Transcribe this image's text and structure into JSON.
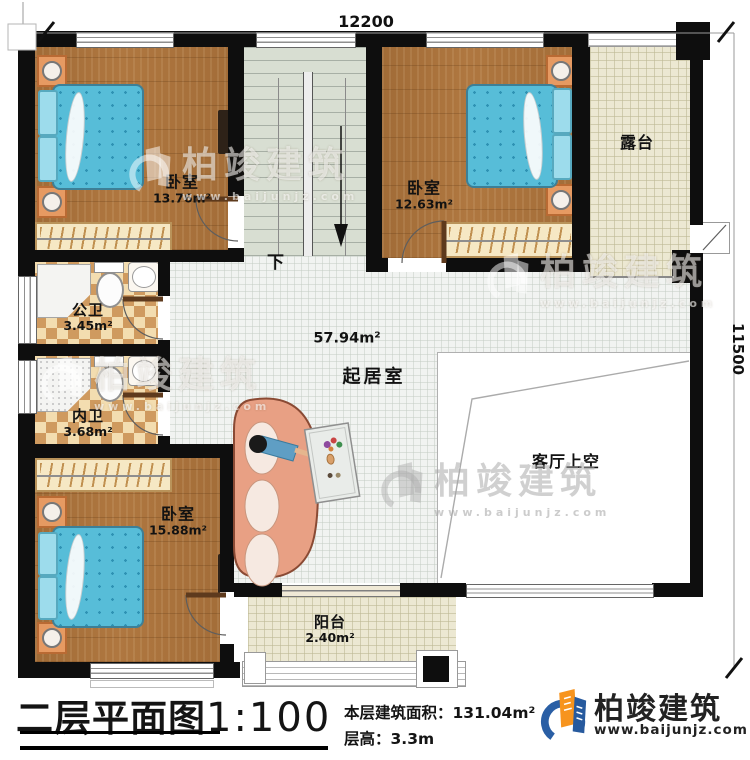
{
  "dims": {
    "width_label": "12200",
    "height_label": "11500"
  },
  "rooms": {
    "bedroom_tl": {
      "name": "卧室",
      "area": "13.76m²"
    },
    "bedroom_tr": {
      "name": "卧室",
      "area": "12.63m²"
    },
    "bedroom_bl": {
      "name": "卧室",
      "area": "15.88m²"
    },
    "terrace": {
      "name": "露台"
    },
    "public_bath": {
      "name": "公卫",
      "area": "3.45m²"
    },
    "inner_bath": {
      "name": "内卫",
      "area": "3.68m²"
    },
    "living": {
      "name": "起居室",
      "area": "57.94m²"
    },
    "living_void": {
      "name": "客厅上空"
    },
    "balcony": {
      "name": "阳台",
      "area": "2.40m²"
    },
    "stairs": {
      "down_label": "下"
    }
  },
  "title_block": {
    "title": "二层平面图",
    "scale": "1:100",
    "area_label": "本层建筑面积：",
    "area_value": "131.04m²",
    "height_label": "层高：",
    "height_value": "3.3m"
  },
  "brand": {
    "name": "柏竣建筑",
    "site": "www.baijunjz.com"
  },
  "watermark": {
    "name": "柏竣建筑",
    "site": "www.baijunjz.com"
  },
  "colors": {
    "wall": "#0e0e0e",
    "wood": "#af7740",
    "bed": "#57bdd8",
    "brand_blue": "#2a5fa5",
    "brand_orange": "#f7941e"
  }
}
